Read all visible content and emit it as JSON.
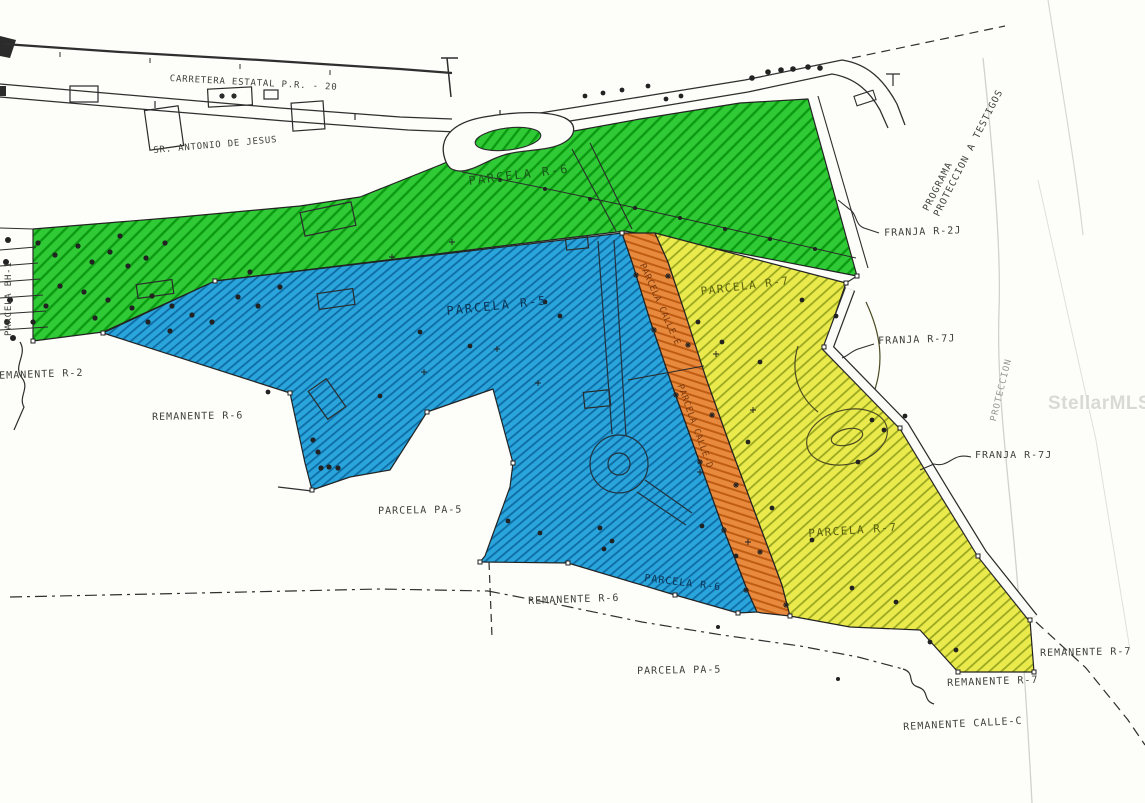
{
  "labels": {
    "carretera": "CARRETERA ESTATAL P.R. - 20",
    "antonio": "SR. ANTONIO DE JESUS",
    "parcela_r6_top": "PARCELA R-6",
    "franja_r2j": "FRANJA R-2J",
    "programa_1": "PROGRAMA",
    "programa_2": "PROTECCION A TESTIGOS",
    "parcela_r7_top": "PARCELA R-7",
    "franja_r7j_top": "FRANJA R-7J",
    "franja_r7j_mid": "FRANJA R-7J",
    "proteccion": "PROTECCION",
    "parcela_r5": "PARCELA R-5",
    "parcela_bh1": "PARCELA BH-1",
    "remanente_r2": "REMANENTE R-2",
    "remanente_r6_left": "REMANENTE R-6",
    "parcela_pa5_left": "PARCELA PA-5",
    "calle_e": "PARCELA CALLE-E",
    "calle_d": "PARCELA CALLE-D",
    "parcela_r7_bottom": "PARCELA R-7",
    "parcela_r6_bottom": "PARCELA R-6",
    "remanente_r6_bottom": "REMANENTE R-6",
    "parcela_pa5_bottom": "PARCELA PA-5",
    "remanente_r7_right": "REMANENTE R-7",
    "remanente_r7_bottom": "REMANENTE R-7",
    "remanente_calle_c": "REMANENTE CALLE-C",
    "watermark": "StellarMLS"
  },
  "zones": [
    {
      "name": "PARCELA R-6",
      "fill": "#2fca35"
    },
    {
      "name": "PARCELA R-5",
      "fill": "#29a5dc"
    },
    {
      "name": "PARCELA R-7",
      "fill": "#eaea4c"
    },
    {
      "name": "PARCELA CALLE-D",
      "fill": "#e88a3e"
    }
  ],
  "colors": {
    "green_hatch": "#0c9a12",
    "blue_hatch": "#0f6ba4",
    "yellow_hatch": "#9aa821",
    "orange_hatch": "#bf5c14",
    "linework": "#2b2b2b",
    "paper": "#fdfdfa"
  }
}
